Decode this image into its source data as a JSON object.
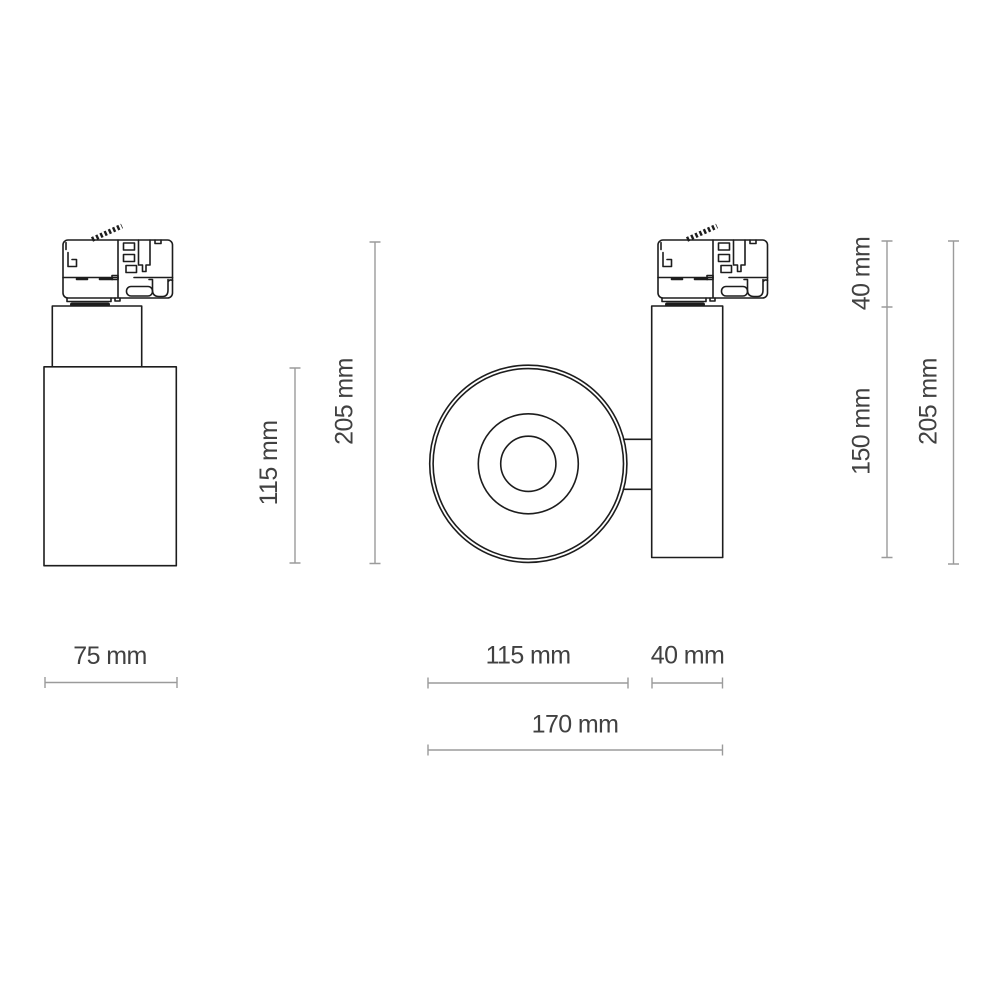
{
  "drawing": {
    "type": "technical-dimension-drawing",
    "subject": "track-mounted spotlight, side and front views",
    "unit": "mm"
  },
  "labels": {
    "left_body_height": "115 mm",
    "left_total_height": "205 mm",
    "left_width": "75 mm",
    "front_diameter": "115 mm",
    "side_depth": "40 mm",
    "total_length": "170 mm",
    "adapter_height": "40 mm",
    "right_body_height": "150 mm",
    "right_total_height": "205 mm"
  },
  "colors": {
    "outline": "#1d1d1d",
    "dimension_line": "#9b9b9b",
    "label_text": "#414141",
    "background": "#ffffff"
  }
}
